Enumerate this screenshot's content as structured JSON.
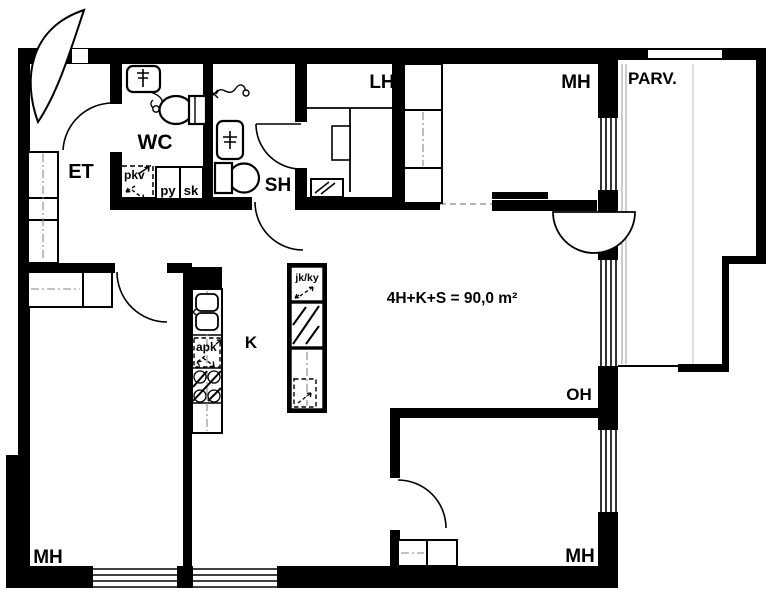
{
  "plan": {
    "type": "apartment-floor-plan",
    "area_label": "4H+K+S = 90,0 m²",
    "rooms": {
      "et": "ET",
      "wc": "WC",
      "sh": "SH",
      "lh": "LH",
      "mh_top": "MH",
      "parv": "PARV.",
      "k": "K",
      "oh": "OH",
      "mh_bottom_left": "MH",
      "mh_bottom_right": "MH"
    },
    "closets": {
      "pkv": "pkv",
      "py": "py",
      "sk": "sk"
    },
    "appliances": {
      "apk": "apk",
      "jk_ky": "jk/ky"
    },
    "colors": {
      "wall": "#000000",
      "background": "#ffffff",
      "centerline": "#8a8a8a"
    }
  }
}
